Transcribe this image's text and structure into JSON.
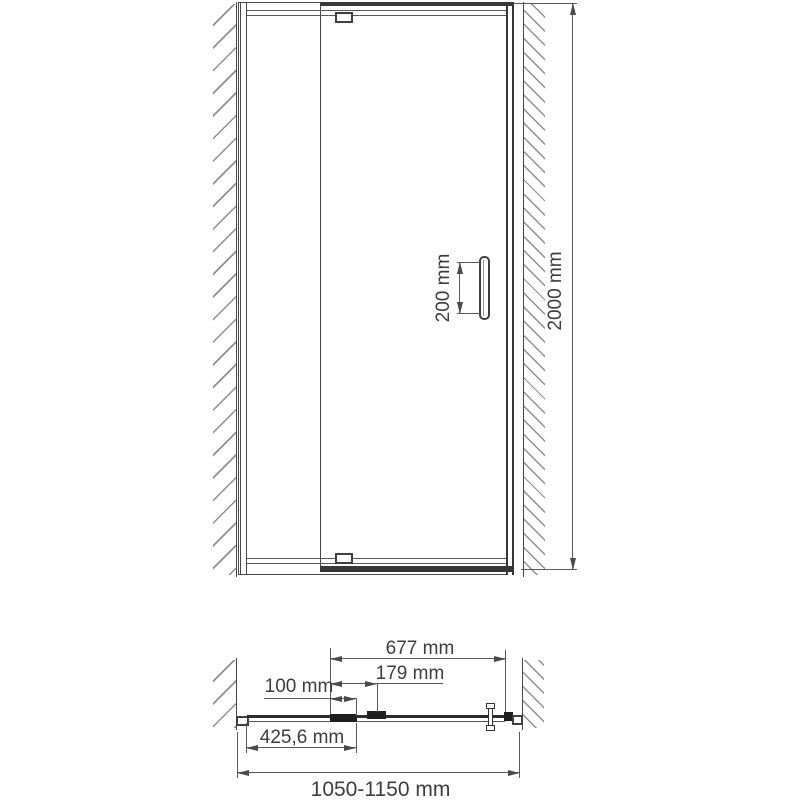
{
  "colors": {
    "line": "#474747",
    "dark_profile": "#383838",
    "dim_line": "#5a5a5a",
    "text": "#3d3d3d",
    "hatch": "#8f8f8f",
    "background": "#ffffff"
  },
  "front_view": {
    "dimensions": {
      "overall_height": {
        "label": "2000 mm"
      },
      "handle_length": {
        "label": "200 mm"
      }
    }
  },
  "plan_view": {
    "dimensions": {
      "door_panel_width": {
        "label": "677 mm"
      },
      "hinge_offset": {
        "label": "179 mm"
      },
      "adjustment_overlap": {
        "label": "100 mm"
      },
      "fixed_panel_width": {
        "label": "425,6 mm"
      },
      "overall_width": {
        "label": "1050-1150 mm"
      }
    }
  }
}
